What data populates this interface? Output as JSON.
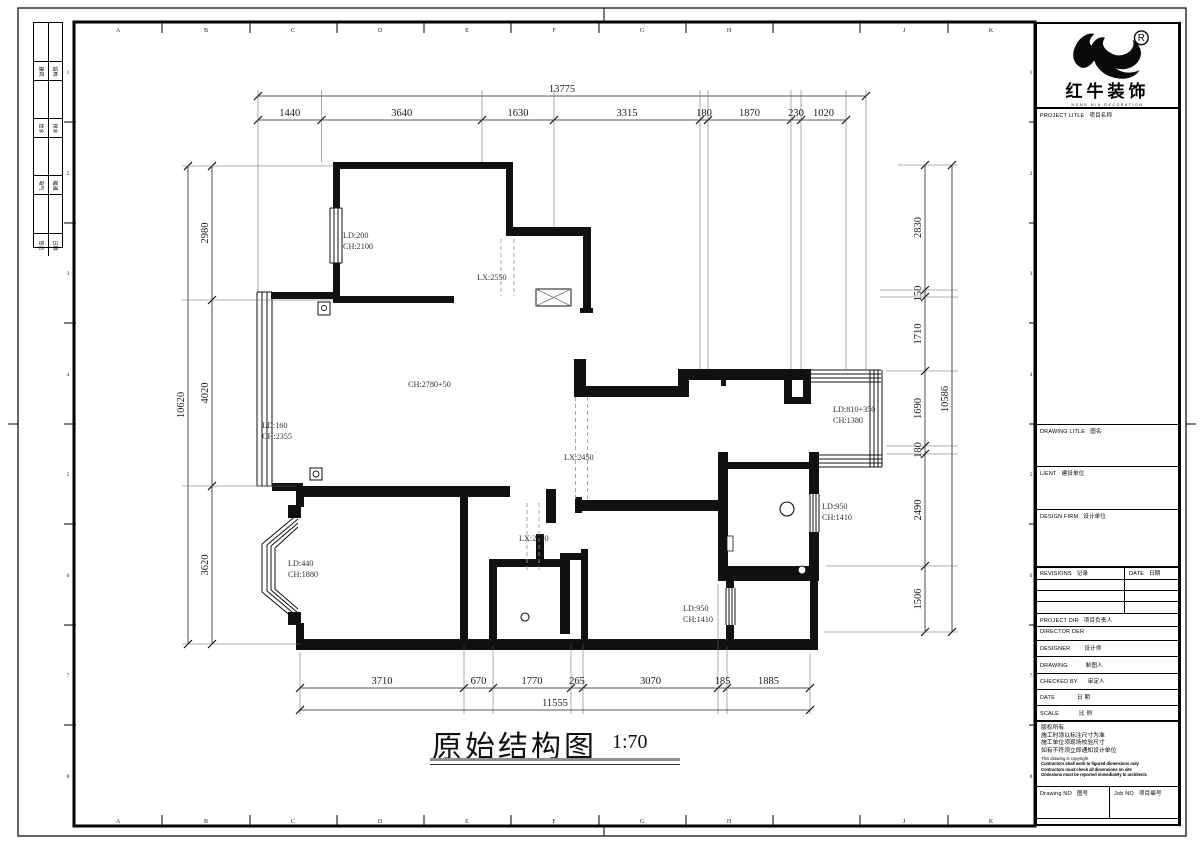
{
  "frame": {
    "zone_letters": [
      "A",
      "B",
      "C",
      "D",
      "E",
      "F",
      "G",
      "H",
      "J",
      "K"
    ],
    "zone_numbers": [
      "1",
      "2",
      "3",
      "4",
      "5",
      "6",
      "7",
      "8"
    ]
  },
  "sign_strip": {
    "rows": [
      [
        "建筑",
        "结构"
      ],
      [
        "给水",
        "排水"
      ],
      [
        "电气",
        "暖通"
      ],
      [
        "签名",
        "日期"
      ]
    ]
  },
  "logo": {
    "registered": "R",
    "brand": "红牛装饰",
    "sub": "HONG NIU DECORATION"
  },
  "title_block": {
    "project_title": {
      "en": "PROJECT LITLE",
      "zh": "项目名称"
    },
    "drawing_title": {
      "en": "DRAWING LITLE",
      "zh": "图名"
    },
    "client": {
      "en": "LIENT",
      "zh": "建设单位"
    },
    "design_firm": {
      "en": "DESIGN FIRM",
      "zh": "设计单位"
    },
    "revisions": {
      "en": "REVISIONS",
      "zh": "记录"
    },
    "date_col": {
      "en": "DATE",
      "zh": "日期"
    },
    "project_dir": {
      "en": "PROJECT DIR",
      "zh": "项目负责人"
    },
    "director": {
      "en": "DIRECTOR DER",
      "zh": ""
    },
    "designer": {
      "en": "DESIGNER",
      "zh": "设计师"
    },
    "drawing_by": {
      "en": "DRAWING",
      "zh": "制图人"
    },
    "checked_by": {
      "en": "CHECKED BY",
      "zh": "审定人"
    },
    "date_row": {
      "en": "DATE",
      "zh": "日 期"
    },
    "scale_row": {
      "en": "SCALE",
      "zh": "比 例"
    },
    "notes_zh": [
      "版权所有",
      "施工时须以标注尺寸为准",
      "施工单位须现场校验尺寸",
      "如有不符须立即通知设计单位"
    ],
    "notes_en": [
      "This drawing is copyright",
      "Contractors shall work to figured dimensions only",
      "Contractors must check all dimensions on site",
      "Omissions must be reported immediately to architects"
    ],
    "drawing_no": {
      "en": "Drawing NO",
      "zh": "图号"
    },
    "job_no": {
      "en": "Job NO",
      "zh": "项目编号"
    }
  },
  "drawing": {
    "title": "原始结构图",
    "scale": "1:70",
    "dims": {
      "top_total": "13775",
      "top": [
        "1440",
        "3640",
        "1630",
        "3315",
        "180",
        "1870",
        "230",
        "1020"
      ],
      "left_total": "10620",
      "left": [
        "2980",
        "4020",
        "3620"
      ],
      "right_total": "10586",
      "right": [
        "2830",
        "150",
        "1710",
        "1690",
        "180",
        "2490",
        "1506"
      ],
      "bottom_total": "11555",
      "bottom": [
        "3710",
        "670",
        "1770",
        "265",
        "3070",
        "185",
        "1885"
      ]
    },
    "labels": [
      {
        "text": "LD:200",
        "x": 343,
        "y": 238
      },
      {
        "text": "CH:2100",
        "x": 343,
        "y": 249
      },
      {
        "text": "LX:2550",
        "x": 477,
        "y": 280
      },
      {
        "text": "CH:2780+50",
        "x": 408,
        "y": 387
      },
      {
        "text": "LD:160",
        "x": 262,
        "y": 428
      },
      {
        "text": "CH:2355",
        "x": 262,
        "y": 439
      },
      {
        "text": "LX:2450",
        "x": 564,
        "y": 460
      },
      {
        "text": "LD:810+350",
        "x": 833,
        "y": 412
      },
      {
        "text": "CH:1380",
        "x": 833,
        "y": 423
      },
      {
        "text": "LD:950",
        "x": 822,
        "y": 509
      },
      {
        "text": "CH:1410",
        "x": 822,
        "y": 520
      },
      {
        "text": "LD:440",
        "x": 288,
        "y": 566
      },
      {
        "text": "CH:1880",
        "x": 288,
        "y": 577
      },
      {
        "text": "LX:2550",
        "x": 519,
        "y": 541
      },
      {
        "text": "LD:950",
        "x": 683,
        "y": 611
      },
      {
        "text": "CH:1410",
        "x": 683,
        "y": 622
      }
    ]
  }
}
